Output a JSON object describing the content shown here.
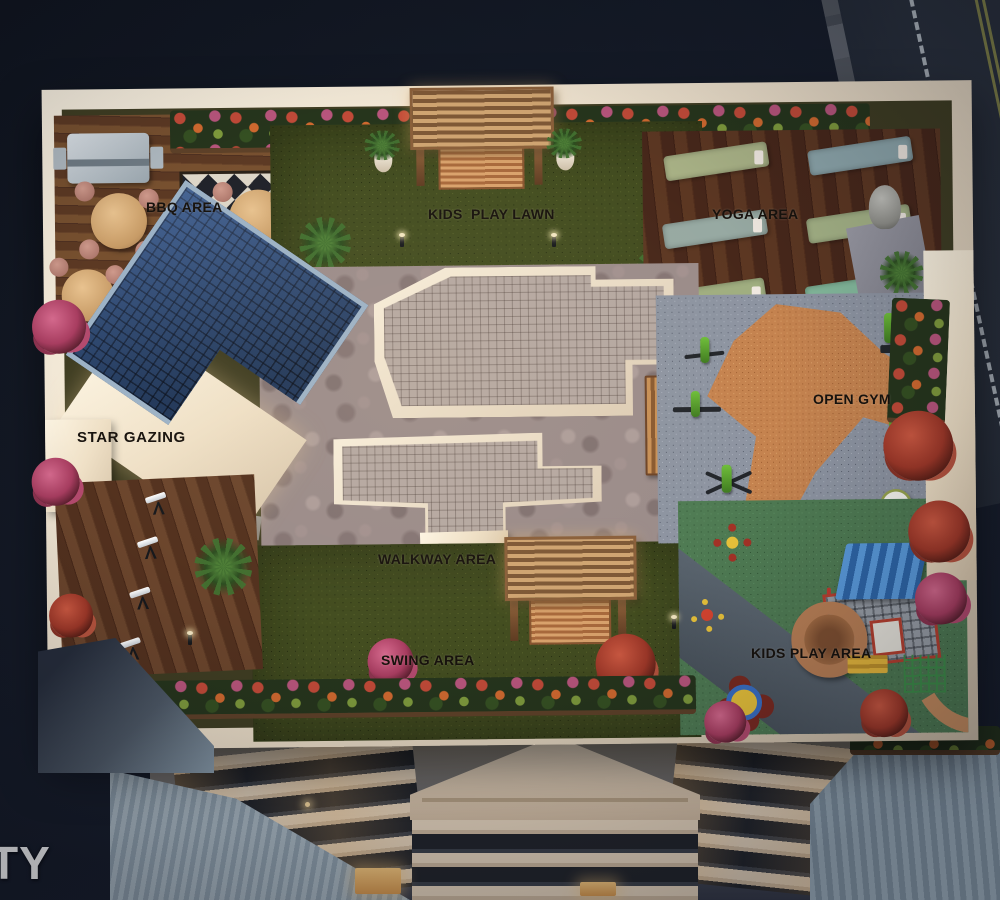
{
  "scene": {
    "description": "Dusk aerial 3D render of a rooftop amenity deck on a residential tower, streets at top-right, building facade with pediment below",
    "style": "photoreal architectural visualization"
  },
  "labels": {
    "bbq_area": "BBQ AREA",
    "kids_play_lawn": "KIDS  PLAY LAWN",
    "yoga_area": "YOGA AREA",
    "star_gazing": "STAR GAZING",
    "open_gym": "OPEN GYM",
    "walkway_area": "WALKWAY AREA",
    "swing_area": "SWING AREA",
    "kids_play_area": "KIDS PLAY AREA"
  },
  "watermark": {
    "visible_text": "TY"
  },
  "inventory": {
    "yoga_mats": 6,
    "telescopes": 4,
    "bbq_tables": 3,
    "swing_pergolas": 2,
    "exercise_balls": 2,
    "spinner_toys": 3
  },
  "colors": {
    "sky": "#161c29",
    "street": "#2a313d",
    "parapet_cream": "#eee3d0",
    "lawn_green": "#434d20",
    "bbq_deck_wood": "#6e4a31",
    "yoga_deck_wood": "#53301c",
    "pavers": "#9b8c8a",
    "gym_floor_grey": "#8d94a1",
    "gym_patch_orange": "#c5834f",
    "play_floor_green": "#4f7b53",
    "star_gazing_roof_blue": "#2c4a78",
    "label_text": "#17120d",
    "watermark_text": "#f6f7f8"
  }
}
